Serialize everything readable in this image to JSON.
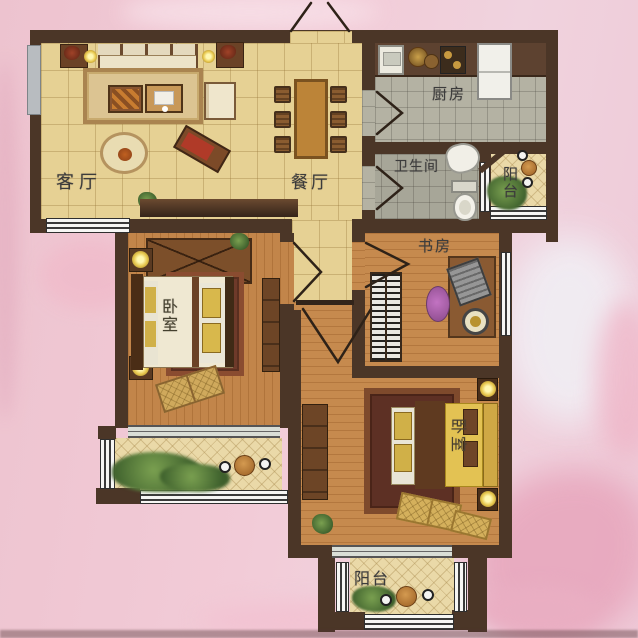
{
  "rooms": {
    "living": {
      "label": "客厅"
    },
    "dining": {
      "label": "餐厅"
    },
    "kitchen": {
      "label": "厨房"
    },
    "bathroom": {
      "label": "卫生间"
    },
    "balcony_right": {
      "label": "阳台"
    },
    "study": {
      "label": "书房"
    },
    "bedroom_left": {
      "label": "卧室"
    },
    "bedroom_right": {
      "label": "卧室"
    },
    "balcony_bottom": {
      "label": "阳台"
    }
  },
  "colors": {
    "wall": "#4b3627",
    "tile_beige": "#e6d194",
    "tile_gray": "#b4b2a3",
    "wood": "#c68a4e",
    "balcony_tile": "#ead9a8",
    "background_pink": "#f2cbd7",
    "lamp_glow": "#ffe98a",
    "window": "#f6f6f4"
  }
}
